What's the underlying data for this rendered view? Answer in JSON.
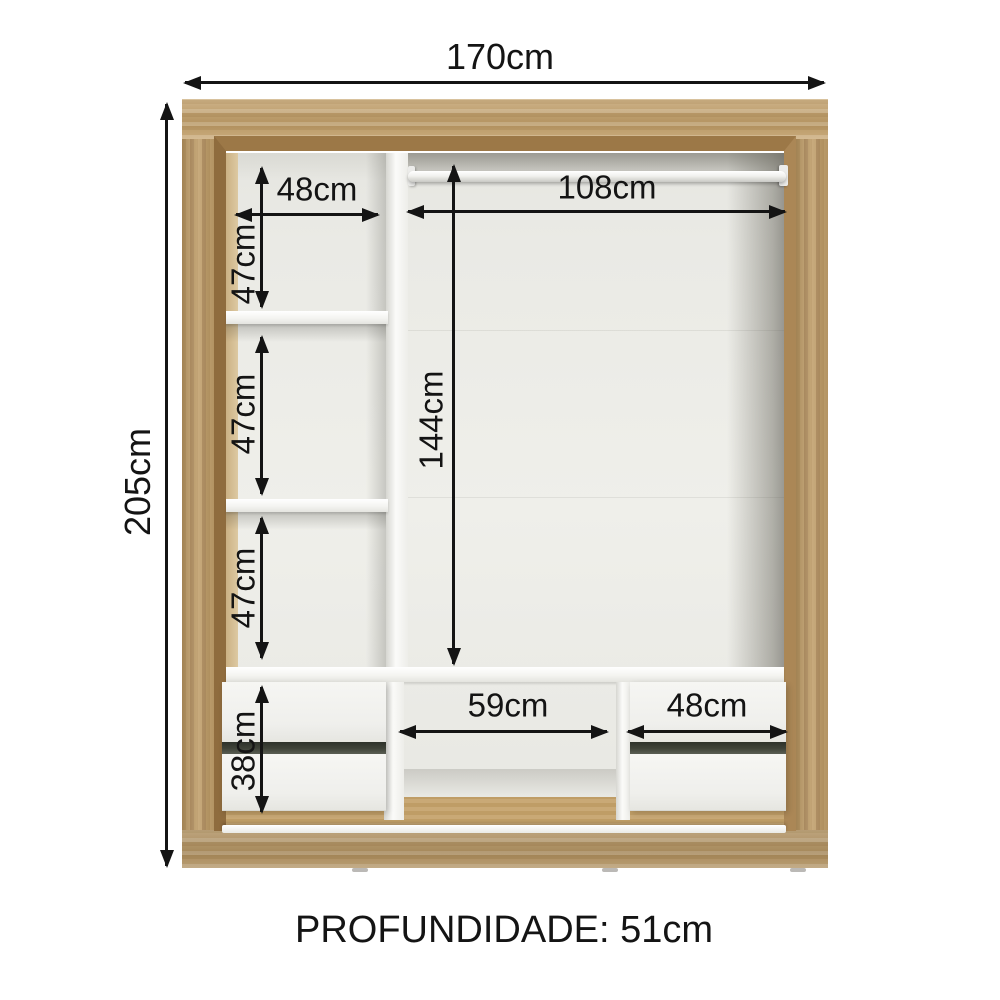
{
  "diagram": {
    "labels": {
      "total_width": "170cm",
      "total_height": "205cm",
      "left_top_width": "48cm",
      "left_section1_height": "47cm",
      "left_section2_height": "47cm",
      "left_section3_height": "47cm",
      "rod_width": "108cm",
      "rod_height": "144cm",
      "drawer_stack_height": "38cm",
      "bottom_middle_width": "59cm",
      "bottom_right_width": "48cm",
      "depth": "PROFUNDIDADE: 51cm"
    },
    "colors": {
      "wood": "#c2a06b",
      "wood_light": "#cfb386",
      "wood_mid": "#b8955f",
      "wood_dark": "#9c7847",
      "interior": "#eaeae5",
      "panel": "#f8f8f5",
      "ink": "#141414",
      "gap": "#3f4339"
    }
  }
}
